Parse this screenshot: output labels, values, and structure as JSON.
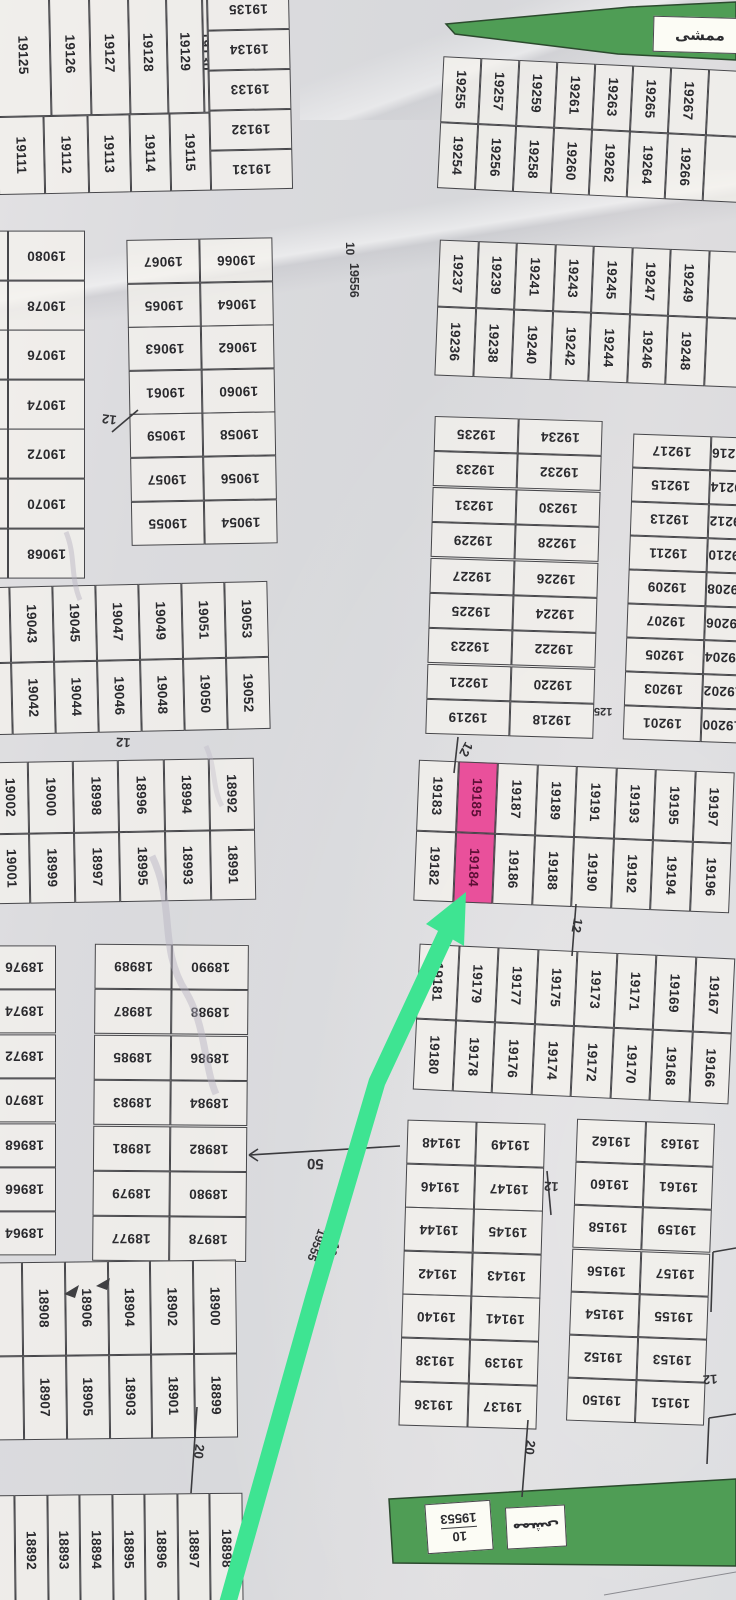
{
  "meta": {
    "kind": "cadastral plot map (scanned survey plat, rotated)",
    "highlighted_plots": [
      "19185",
      "19184"
    ],
    "highlight_color": "#e9509b",
    "arrow_color": "#3ee492",
    "green_area_color": "#4f9d55"
  },
  "labels": {
    "street_top_w": "10",
    "street_top_n": "19556",
    "street_diag_w": "10",
    "street_diag_n": "19555",
    "park_n": "19553",
    "park_w": "10",
    "park_ar": "ممشى",
    "banner_ar": "ممشى",
    "d12a": "12",
    "d12b": "12",
    "d12c": "12",
    "d12d": "12",
    "d12e": "12",
    "d12f": "12",
    "d125": "125",
    "d50": "50",
    "d20a": "20",
    "d20b": "20"
  },
  "blocks": {
    "A1": [
      "19125",
      "19126",
      "19127",
      "19128",
      "19129",
      "19130"
    ],
    "A2": [
      "19111",
      "19112",
      "19113",
      "19114",
      "19115"
    ],
    "A3": [
      "19135",
      "19134",
      "19133",
      "19132",
      "19131"
    ],
    "S1": [
      {
        "n": "",
        "c": "sliver"
      },
      "19080",
      {
        "n": "",
        "c": "sliver"
      },
      "19078",
      {
        "n": "",
        "c": "sliver"
      },
      "19076",
      {
        "n": "",
        "c": "sliver"
      },
      "19074",
      {
        "n": "",
        "c": "sliver"
      },
      "19072",
      {
        "n": "",
        "c": "sliver"
      },
      "19070",
      {
        "n": "",
        "c": "sliver"
      },
      "19068"
    ],
    "L1": [
      "19067",
      "19066",
      "19065",
      "19064",
      "19063",
      "19062",
      "19061",
      "19060",
      "19059",
      "19058",
      "19057",
      "19056",
      "19055",
      "19054"
    ],
    "L2r1": [
      {
        "n": "",
        "c": "sliver"
      },
      "19043",
      "19045",
      "19047",
      "19049",
      "19051",
      "19053"
    ],
    "L2r2": [
      {
        "n": "",
        "c": "sliver"
      },
      "19042",
      "19044",
      "19046",
      "19048",
      "19050",
      "19052"
    ],
    "L3r1": [
      "19002",
      "19000",
      "18998",
      "18996",
      "18994",
      "18992"
    ],
    "L3r2": [
      "19001",
      "18999",
      "18997",
      "18995",
      "18993",
      "18991"
    ],
    "S2": [
      "18976",
      "18974",
      "18972",
      "18970",
      "18968",
      "18966",
      "18964"
    ],
    "L4": [
      "18989",
      "18990",
      "18987",
      "18988",
      "18985",
      "18986",
      "18983",
      "18984",
      "18981",
      "18982",
      "18979",
      "18980",
      "18977",
      "18978"
    ],
    "L5r1": [
      {
        "n": "",
        "c": "sliver"
      },
      "18908",
      "18906",
      "18904",
      "18902",
      "18900"
    ],
    "L5r2": [
      {
        "n": "",
        "c": "sliver"
      },
      "18907",
      "18905",
      "18903",
      "18901",
      "18899"
    ],
    "L6": [
      {
        "n": "",
        "c": "sliver"
      },
      "18892",
      "18893",
      "18894",
      "18895",
      "18896",
      "18897",
      "18898"
    ],
    "B1": [
      "19255",
      "19257",
      "19259",
      "19261",
      "19263",
      "19265",
      "19267",
      {
        "n": "",
        "c": "cutcell"
      }
    ],
    "B2": [
      "19254",
      "19256",
      "19258",
      "19260",
      "19262",
      "19264",
      "19266",
      {
        "n": "",
        "c": "cutcell"
      }
    ],
    "C1": [
      "19237",
      "19239",
      "19241",
      "19243",
      "19245",
      "19247",
      "19249",
      {
        "n": "",
        "c": "cutcell"
      }
    ],
    "C2": [
      "19236",
      "19238",
      "19240",
      "19242",
      "19244",
      "19246",
      "19248",
      {
        "n": "",
        "c": "cutcell"
      }
    ],
    "D1": [
      "19235",
      "19234",
      "19233",
      "19232",
      "19231",
      "19230",
      "19229",
      "19228",
      "19227",
      "19226",
      "19225",
      "19224",
      "19223",
      "19222",
      "19221",
      "19220",
      "19219",
      "19218"
    ],
    "D2": [
      "19217",
      {
        "n": "19216",
        "c": "cuttail"
      },
      "19215",
      {
        "n": "19214",
        "c": "cuttail"
      },
      "19213",
      {
        "n": "19212",
        "c": "cuttail"
      },
      "19211",
      {
        "n": "19210",
        "c": "cuttail"
      },
      "19209",
      {
        "n": "19208",
        "c": "cuttail"
      },
      "19207",
      {
        "n": "19206",
        "c": "cuttail"
      },
      "19205",
      {
        "n": "19204",
        "c": "cuttail"
      },
      "19203",
      {
        "n": "19202",
        "c": "cuttail"
      },
      "19201",
      {
        "n": "19200",
        "c": "cuttail"
      }
    ],
    "E1": [
      "19183",
      {
        "n": "19185",
        "c": "hl"
      },
      "19187",
      "19189",
      "19191",
      "19193",
      "19195",
      "19197"
    ],
    "E2": [
      "19182",
      {
        "n": "19184",
        "c": "hl"
      },
      "19186",
      "19188",
      "19190",
      "19192",
      "19194",
      "19196"
    ],
    "F1": [
      "19181",
      "19179",
      "19177",
      "19175",
      "19173",
      "19171",
      "19169",
      "19167"
    ],
    "F2": [
      "19180",
      "19178",
      "19176",
      "19174",
      "19172",
      "19170",
      "19168",
      "19166"
    ],
    "G": [
      "19148",
      "19149",
      "19146",
      "19147",
      "19144",
      "19145",
      "19142",
      "19143",
      "19140",
      "19141",
      "19138",
      "19139",
      "19136",
      "19137"
    ],
    "H": [
      "19162",
      "19163",
      "19160",
      "19161",
      "19158",
      "19159",
      "19156",
      "19157",
      "19154",
      "19155",
      "19152",
      "19153",
      "19150",
      "19151"
    ]
  }
}
